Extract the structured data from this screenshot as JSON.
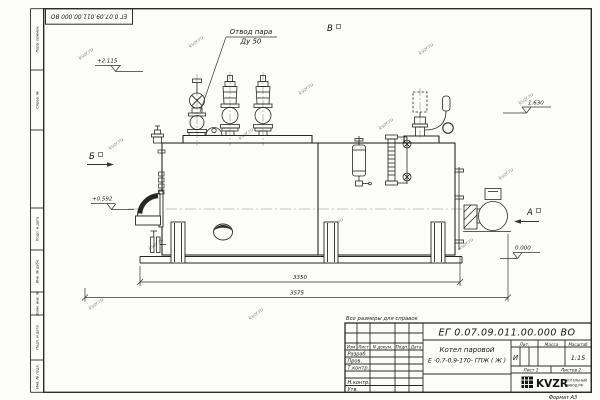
{
  "sheet": {
    "doc_number": "ЕГ 0.07.09.011.00.000  ВО",
    "note": "Все размеры для справок",
    "product_name": "Котел паровой",
    "product_code": "Е -0,7-0,9-170- ГПЖ ( Ж )",
    "liter_label": "Лит.",
    "mass_label": "Масса",
    "scale_label": "Масштаб",
    "liter_value": "И",
    "scale_value": "1:15",
    "sheet_info": "Лист 1",
    "sheets_info": "Листов 2",
    "logo": "KVZR",
    "logo_caption_1": "КОТЕЛЬНЫЙ",
    "logo_caption_2": "ЗАВОД РФ",
    "format_label": "Формат А3",
    "header_cols": [
      "Изм",
      "Лист",
      "N докум.",
      "Подп.",
      "Дата"
    ],
    "sign_labels": [
      "Разраб.",
      "Пров.",
      "Т.контр.",
      "Н.контр.",
      "Утв."
    ],
    "margin_labels": [
      "Перв. примен.",
      "Справ. №",
      "Подп. и дата",
      "Инв. № дубл.",
      "Взам. инв. №",
      "Подп. и дата",
      "Инв. № подл."
    ],
    "watermark": "kvzr.ru"
  },
  "annotations": {
    "callout_line1": "Отвод пара",
    "callout_line2": "Ду 50",
    "view_a": "А",
    "view_b": "Б",
    "view_v": "В",
    "elev_top": "+2.115",
    "elev_right": "1.630",
    "elev_mid": "+0.592",
    "elev_zero": "0.000",
    "dim_inner": "3350",
    "dim_outer": "3575"
  }
}
